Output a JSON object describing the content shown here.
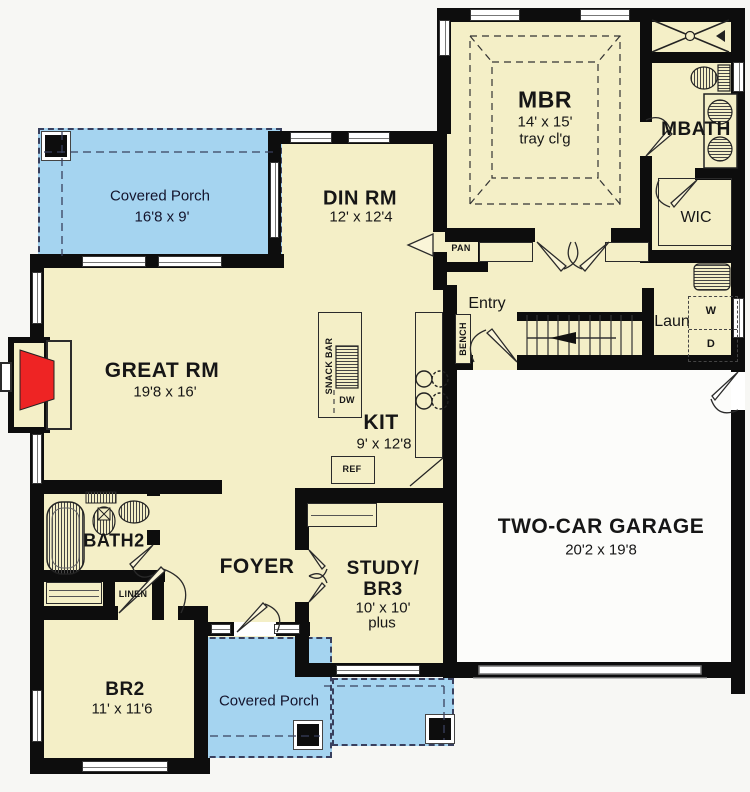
{
  "colors": {
    "background": "#f7f7f4",
    "floor": "#f4efc7",
    "porch": "#a5d4f0",
    "wall": "#0d0d0d",
    "garage_floor": "#fcfcfa",
    "fireplace": "#ee2424"
  },
  "rooms": {
    "mbr": {
      "name": "MBR",
      "dims": "14' x 15'",
      "note": "tray cl'g"
    },
    "mbath": {
      "name": "MBATH"
    },
    "wic": {
      "name": "WIC"
    },
    "porch_top": {
      "name": "Covered Porch",
      "dims": "16'8 x 9'"
    },
    "din": {
      "name": "DIN RM",
      "dims": "12' x 12'4"
    },
    "entry": {
      "name": "Entry"
    },
    "laun": {
      "name": "Laun"
    },
    "great": {
      "name": "GREAT RM",
      "dims": "19'8 x 16'"
    },
    "kit": {
      "name": "KIT",
      "dims": "9' x 12'8"
    },
    "bath2": {
      "name": "BATH2"
    },
    "foyer": {
      "name": "FOYER"
    },
    "study": {
      "line1": "STUDY/",
      "line2": "BR3",
      "dims": "10' x 10'",
      "note": "plus"
    },
    "garage": {
      "name": "TWO-CAR GARAGE",
      "dims": "20'2 x 19'8"
    },
    "br2": {
      "name": "BR2",
      "dims": "11' x 11'6"
    },
    "porch_bottom": {
      "name": "Covered Porch"
    }
  },
  "fixtures": {
    "pan": "PAN",
    "bench": "BENCH",
    "snack_bar": "SNACK BAR",
    "dw": "DW",
    "ref": "REF",
    "linen": "LINEN",
    "washer": "W",
    "dryer": "D"
  }
}
